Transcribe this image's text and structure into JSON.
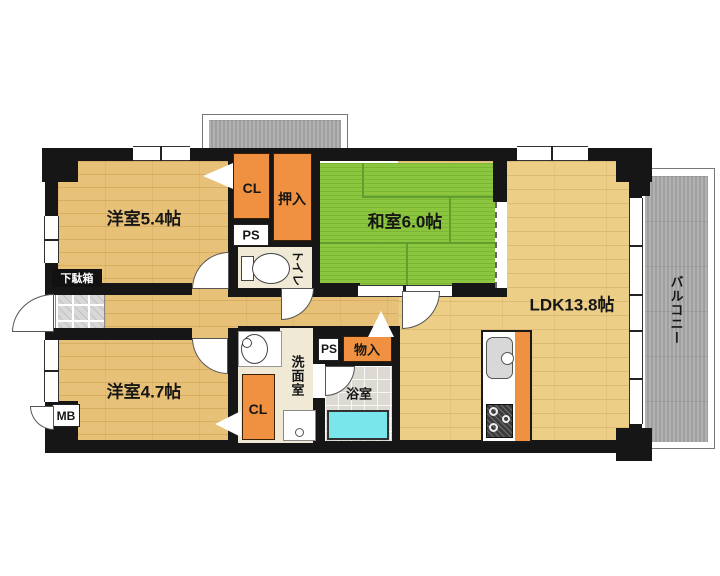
{
  "floor_plan": {
    "rooms": {
      "western_room_1": {
        "label": "洋室5.4帖"
      },
      "japanese_room": {
        "label": "和室6.0帖"
      },
      "ldk": {
        "label": "LDK13.8帖"
      },
      "western_room_2": {
        "label": "洋室4.7帖"
      },
      "toilet": {
        "label": "トイレ"
      },
      "washroom": {
        "label": "洗面室"
      },
      "bathroom": {
        "label": "浴室"
      },
      "balcony": {
        "label": "バルコニー"
      }
    },
    "storage": {
      "closet_1": {
        "label": "CL"
      },
      "closet_2": {
        "label": "CL"
      },
      "oshiire": {
        "label": "押入"
      },
      "mono_ire": {
        "label": "物入"
      },
      "shoe_cabinet": {
        "label": "下駄箱"
      }
    },
    "utilities": {
      "pipe_space_1": {
        "label": "PS"
      },
      "pipe_space_2": {
        "label": "PS"
      },
      "meter_box": {
        "label": "MB"
      }
    }
  },
  "palette": {
    "wall": "#161616",
    "wood_room": "#e8c178",
    "wood_ldk": "#ecce87",
    "tatami": "#8bc63e",
    "tatami_line": "#5f9e2f",
    "closet_orange": "#ef9140",
    "balcony_gray": "#a9a9a9",
    "tile_gray": "#d8d8d8",
    "bath_gray": "#dcdad2",
    "cream": "#efe9d6",
    "tub_cyan": "#79e6ec"
  }
}
